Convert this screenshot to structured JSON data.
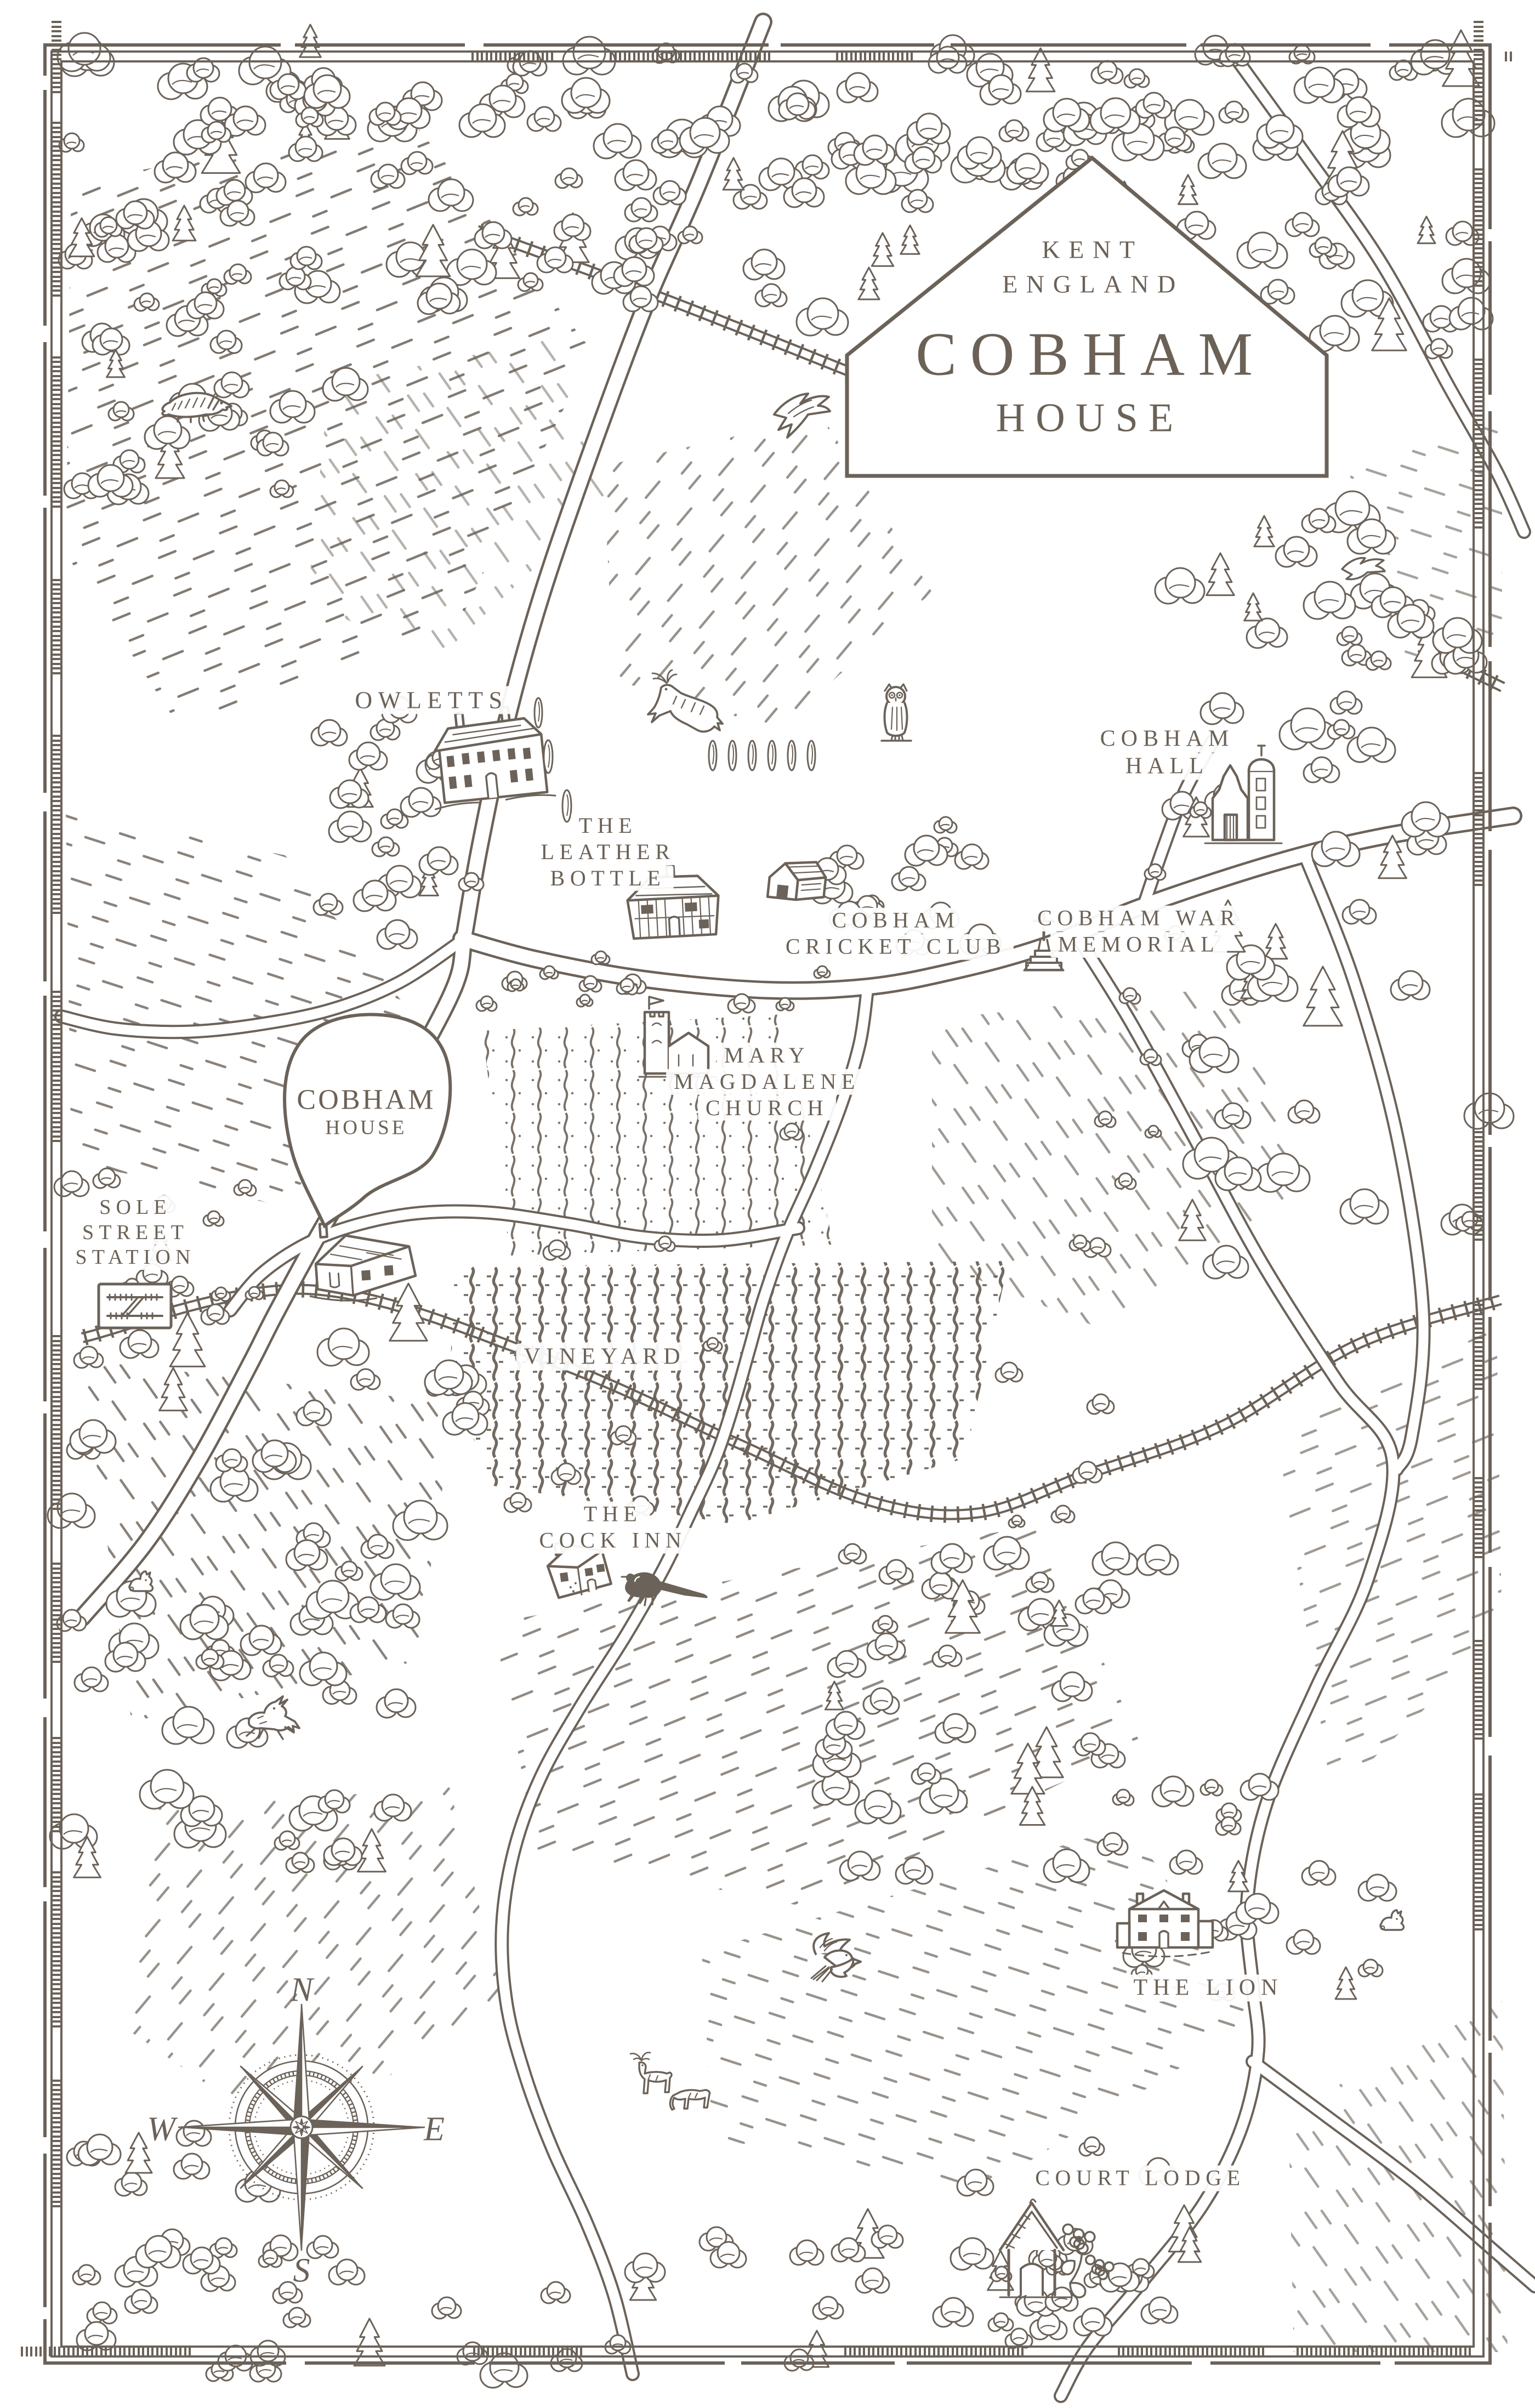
{
  "cartouche": {
    "region": "KENT",
    "country": "ENGLAND",
    "name": "COBHAM",
    "kind": "HOUSE"
  },
  "marker": {
    "lines": [
      "COBHAM",
      "HOUSE"
    ]
  },
  "locations": {
    "owletts": {
      "lines": [
        "OWLETTS"
      ]
    },
    "leather_bottle": {
      "lines": [
        "THE",
        "LEATHER",
        "BOTTLE"
      ]
    },
    "cricket_club": {
      "lines": [
        "COBHAM",
        "CRICKET CLUB"
      ]
    },
    "cobham_hall": {
      "lines": [
        "COBHAM",
        "HALL"
      ]
    },
    "war_memorial": {
      "lines": [
        "COBHAM WAR",
        "MEMORIAL"
      ]
    },
    "church": {
      "lines": [
        "MARY",
        "MAGDALENE",
        "CHURCH"
      ]
    },
    "station": {
      "lines": [
        "SOLE",
        "STREET",
        "STATION"
      ]
    },
    "vineyard": {
      "lines": [
        "VINEYARD"
      ]
    },
    "cock_inn": {
      "lines": [
        "THE",
        "COCK INN"
      ]
    },
    "lion": {
      "lines": [
        "THE LION"
      ]
    },
    "court_lodge": {
      "lines": [
        "COURT LODGE"
      ]
    }
  },
  "compass": {
    "n": "N",
    "e": "E",
    "s": "S",
    "w": "W"
  },
  "colors": {
    "ink": "#6b6259",
    "text": "#6b6156",
    "paper": "#ffffff"
  }
}
